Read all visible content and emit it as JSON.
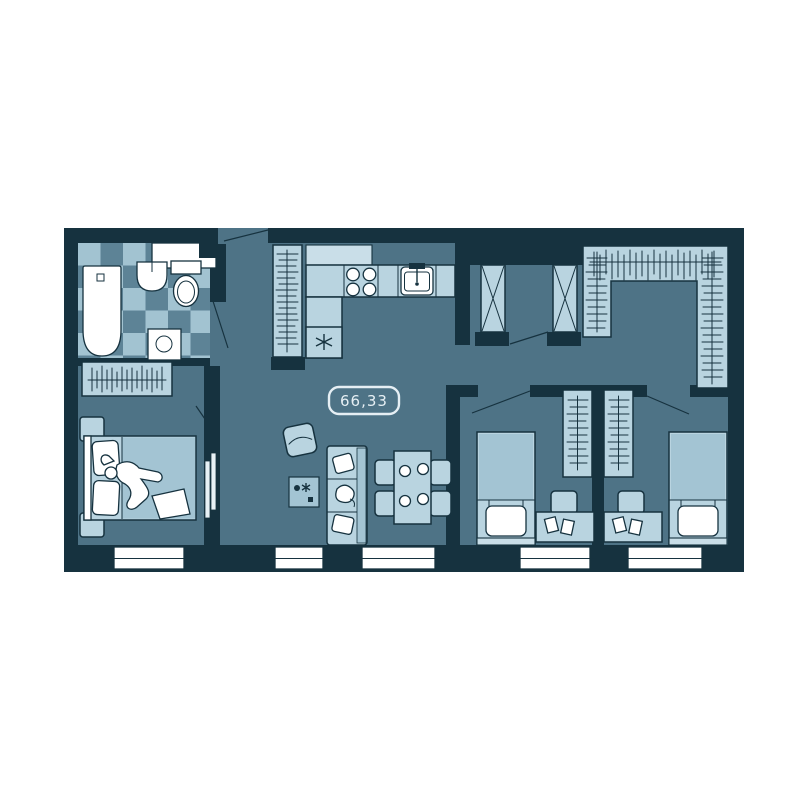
{
  "floorplan": {
    "area_label": "66,33",
    "colors": {
      "page_bg": "#ffffff",
      "wall": "#16323f",
      "floor": "#4e7386",
      "furniture": "#b9d4e0",
      "furniture_soft": "#a3c4d3",
      "furniture_pale": "#c9dee8",
      "fixture": "#ffffff",
      "tile_light": "#a2c3d1",
      "tile_dark": "#5d8396",
      "label": "#e6eff4"
    },
    "legend": [
      "bathtub",
      "bathroom-sink",
      "toilet",
      "bathroom-counter",
      "floor-cabinet",
      "wardrobe-hangers",
      "kitchen-counter",
      "stove-burners",
      "kitchen-sink",
      "fridge-snowflake",
      "armchair",
      "sofa",
      "coffee-table",
      "dining-table",
      "dining-chairs",
      "plates",
      "double-bed",
      "person-lying",
      "nightstands",
      "sliding-door",
      "ventilation-shafts",
      "walk-in-closet",
      "single-bed",
      "desk",
      "desk-chair",
      "papers",
      "windows",
      "door-swings"
    ],
    "window_count": 5
  }
}
